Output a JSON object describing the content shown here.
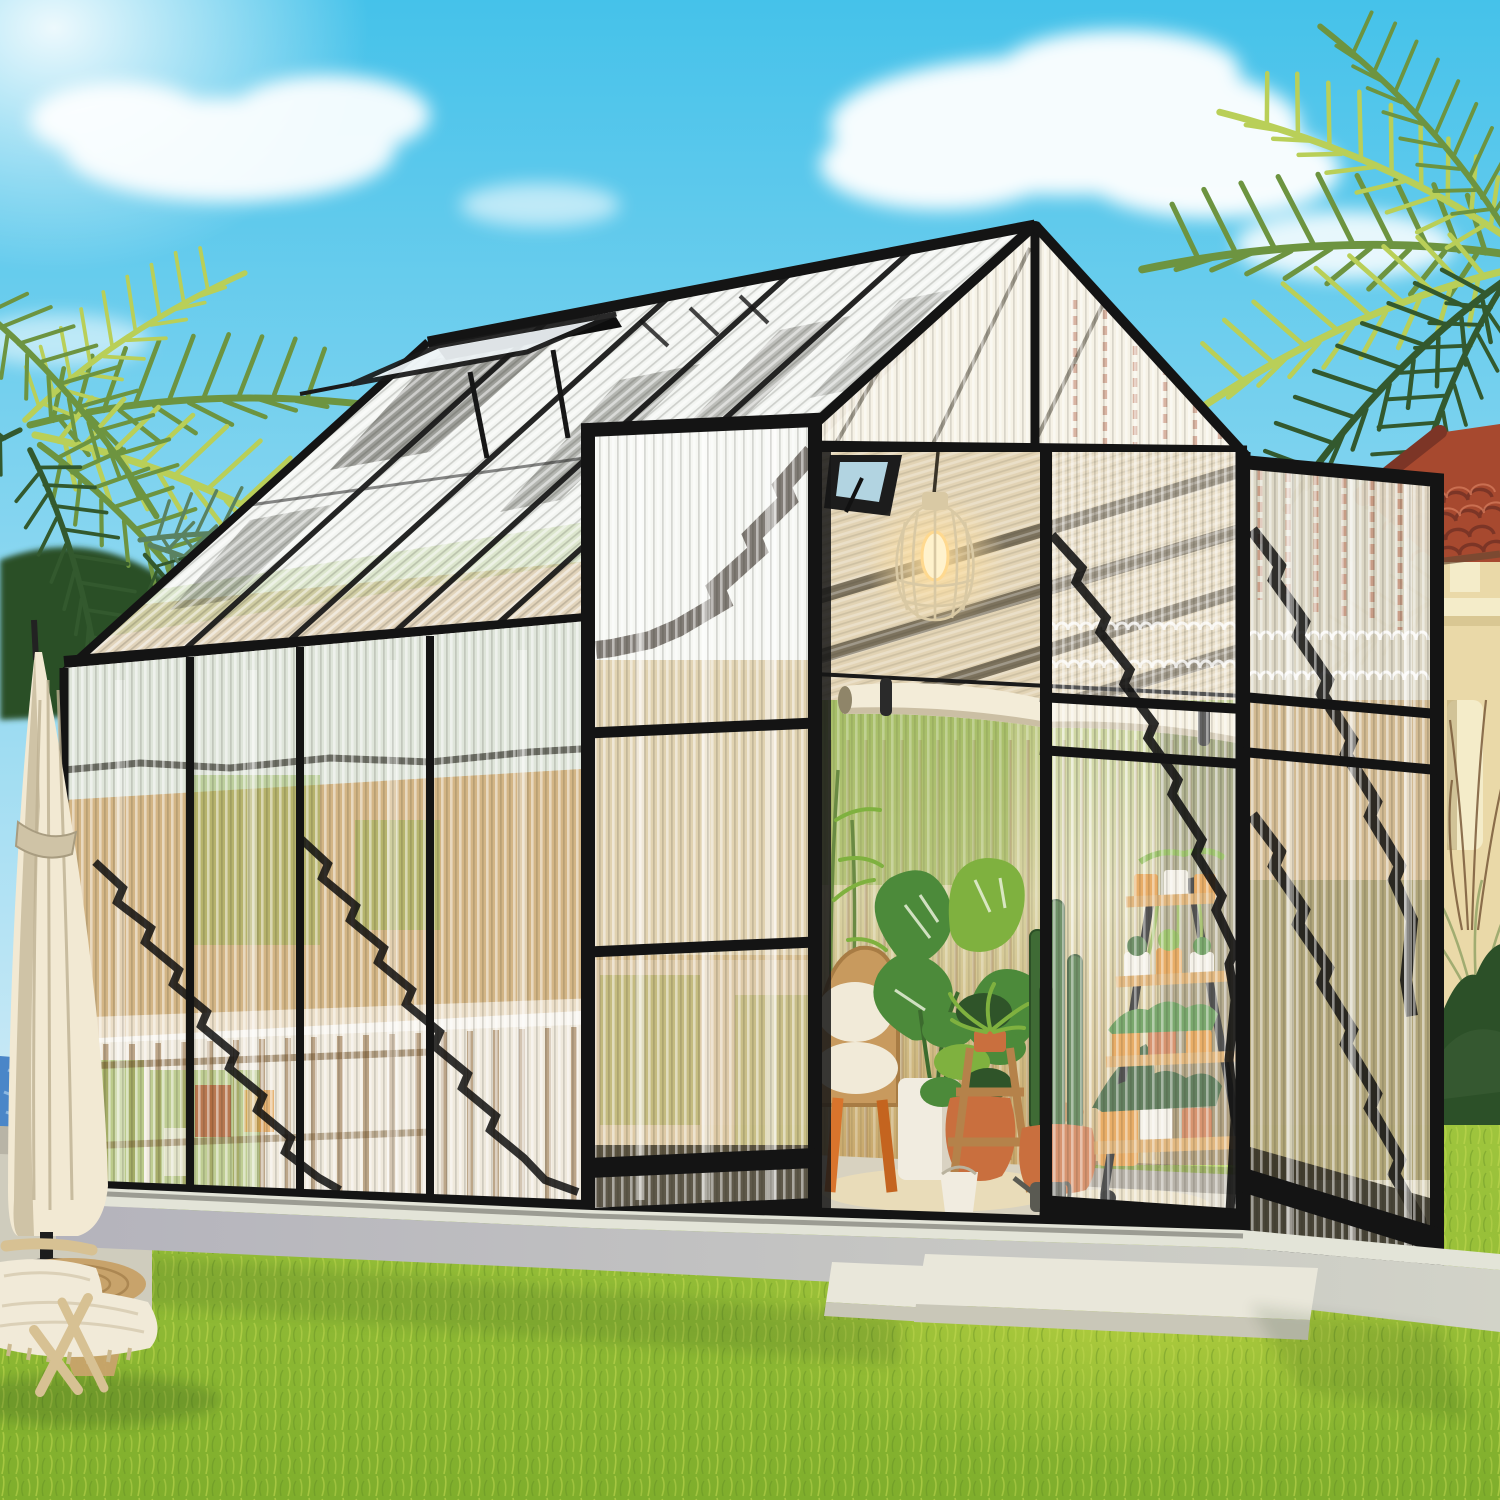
{
  "image": {
    "title": "Backyard greenhouse with black aluminum frame and corrugated polycarbonate panels, doors open showing potted plants, plant ladder shelf and a hanging cage lamp; palm trees, tile-roof house, cream patio umbrella, pool edge and a woven lounge chair on a bright green lawn",
    "width": 1500,
    "height": 1500
  },
  "colors": {
    "skyTop": "#45c2ea",
    "skyBottom": "#cdeaf6",
    "cloud": "#ffffff",
    "palmLight": "#b9cf58",
    "palmMid": "#6d9440",
    "palmDark": "#33592e",
    "palmTeal": "#5a8261",
    "treeDark": "#2c5028",
    "frame": "#141414",
    "frameSoft": "#2b2b26",
    "panelWhite": "#f3f5f2",
    "panelCream": "#efe9dc",
    "panelAmber": "#c9a368",
    "panelAmberDeep": "#8a6436",
    "panelGreen": "#8fb149",
    "panelGreenPale": "#b9c87e",
    "panelRed": "#b0573c",
    "roofTile": "#a7492f",
    "roofTileDark": "#7c3526",
    "roofTileLight": "#d3795a",
    "buildingWall": "#ead9a8",
    "buildingTrim": "#f4ecc9",
    "buildingShade": "#d9c793",
    "poolWater": "#4a86c8",
    "poolCoping": "#b8b4a6",
    "poolDeck": "#cfccbd",
    "umbrella": "#f2e9d3",
    "umbrellaShade": "#cfc3a6",
    "grassTop": "#9fc53d",
    "grassBottom": "#7fae2c",
    "grassGlow": "#d7e34a",
    "grassBlade": "#c4da52",
    "grassBladeDark": "#5e8a22",
    "plinthTop": "#e3e4d8",
    "plinthFace": "#b4b3bc",
    "plinthFaceLit": "#d2d3c8",
    "paver": "#e9e7da",
    "floor": "#d8d2c0",
    "floorLight": "#f3e2b5",
    "interiorTan": "#e2d3b4",
    "woodSlat": "#c9a86b",
    "shelfWood": "#d8a054",
    "shelfWoodEdge": "#a9752f",
    "stoolWood": "#b5824a",
    "potTerracotta": "#c96f3e",
    "potOrange": "#e09133",
    "potWhite": "#f1ece0",
    "potRed": "#b34a2c",
    "leaf": "#4c8a3a",
    "leafLight": "#7fb13f",
    "leafDark": "#2f5429",
    "cactus": "#3f6b35",
    "lampGlow": "#ffdf9e",
    "lampBulb": "#fff2cc",
    "lampMetal": "#d9c9a4",
    "shadeFabric": "#f3ecd8",
    "shadeFabricShade": "#cbbfa4",
    "chairWood": "#d7c193",
    "cushion": "#f1ead8",
    "tableWeave": "#c8a36b",
    "wicker": "#c89a5e",
    "shadow": "#1c3a14"
  },
  "scene": {
    "objects": [
      {
        "name": "sky"
      },
      {
        "name": "clouds"
      },
      {
        "name": "palm-tree-left"
      },
      {
        "name": "palm-tree-right"
      },
      {
        "name": "house-with-tile-roof"
      },
      {
        "name": "garden-bushes"
      },
      {
        "name": "lawn"
      },
      {
        "name": "pool-edge"
      },
      {
        "name": "patio-umbrella"
      },
      {
        "name": "greenhouse"
      },
      {
        "name": "roof-vent-window"
      },
      {
        "name": "left-door-open"
      },
      {
        "name": "right-door-open"
      },
      {
        "name": "hanging-cage-lamp"
      },
      {
        "name": "rolled-shade"
      },
      {
        "name": "plant-ladder-shelf"
      },
      {
        "name": "potted-plants"
      },
      {
        "name": "wicker-chair"
      },
      {
        "name": "wooden-stools"
      },
      {
        "name": "concrete-plinth"
      },
      {
        "name": "step-pavers"
      },
      {
        "name": "lounge-chair"
      },
      {
        "name": "side-table"
      }
    ]
  }
}
